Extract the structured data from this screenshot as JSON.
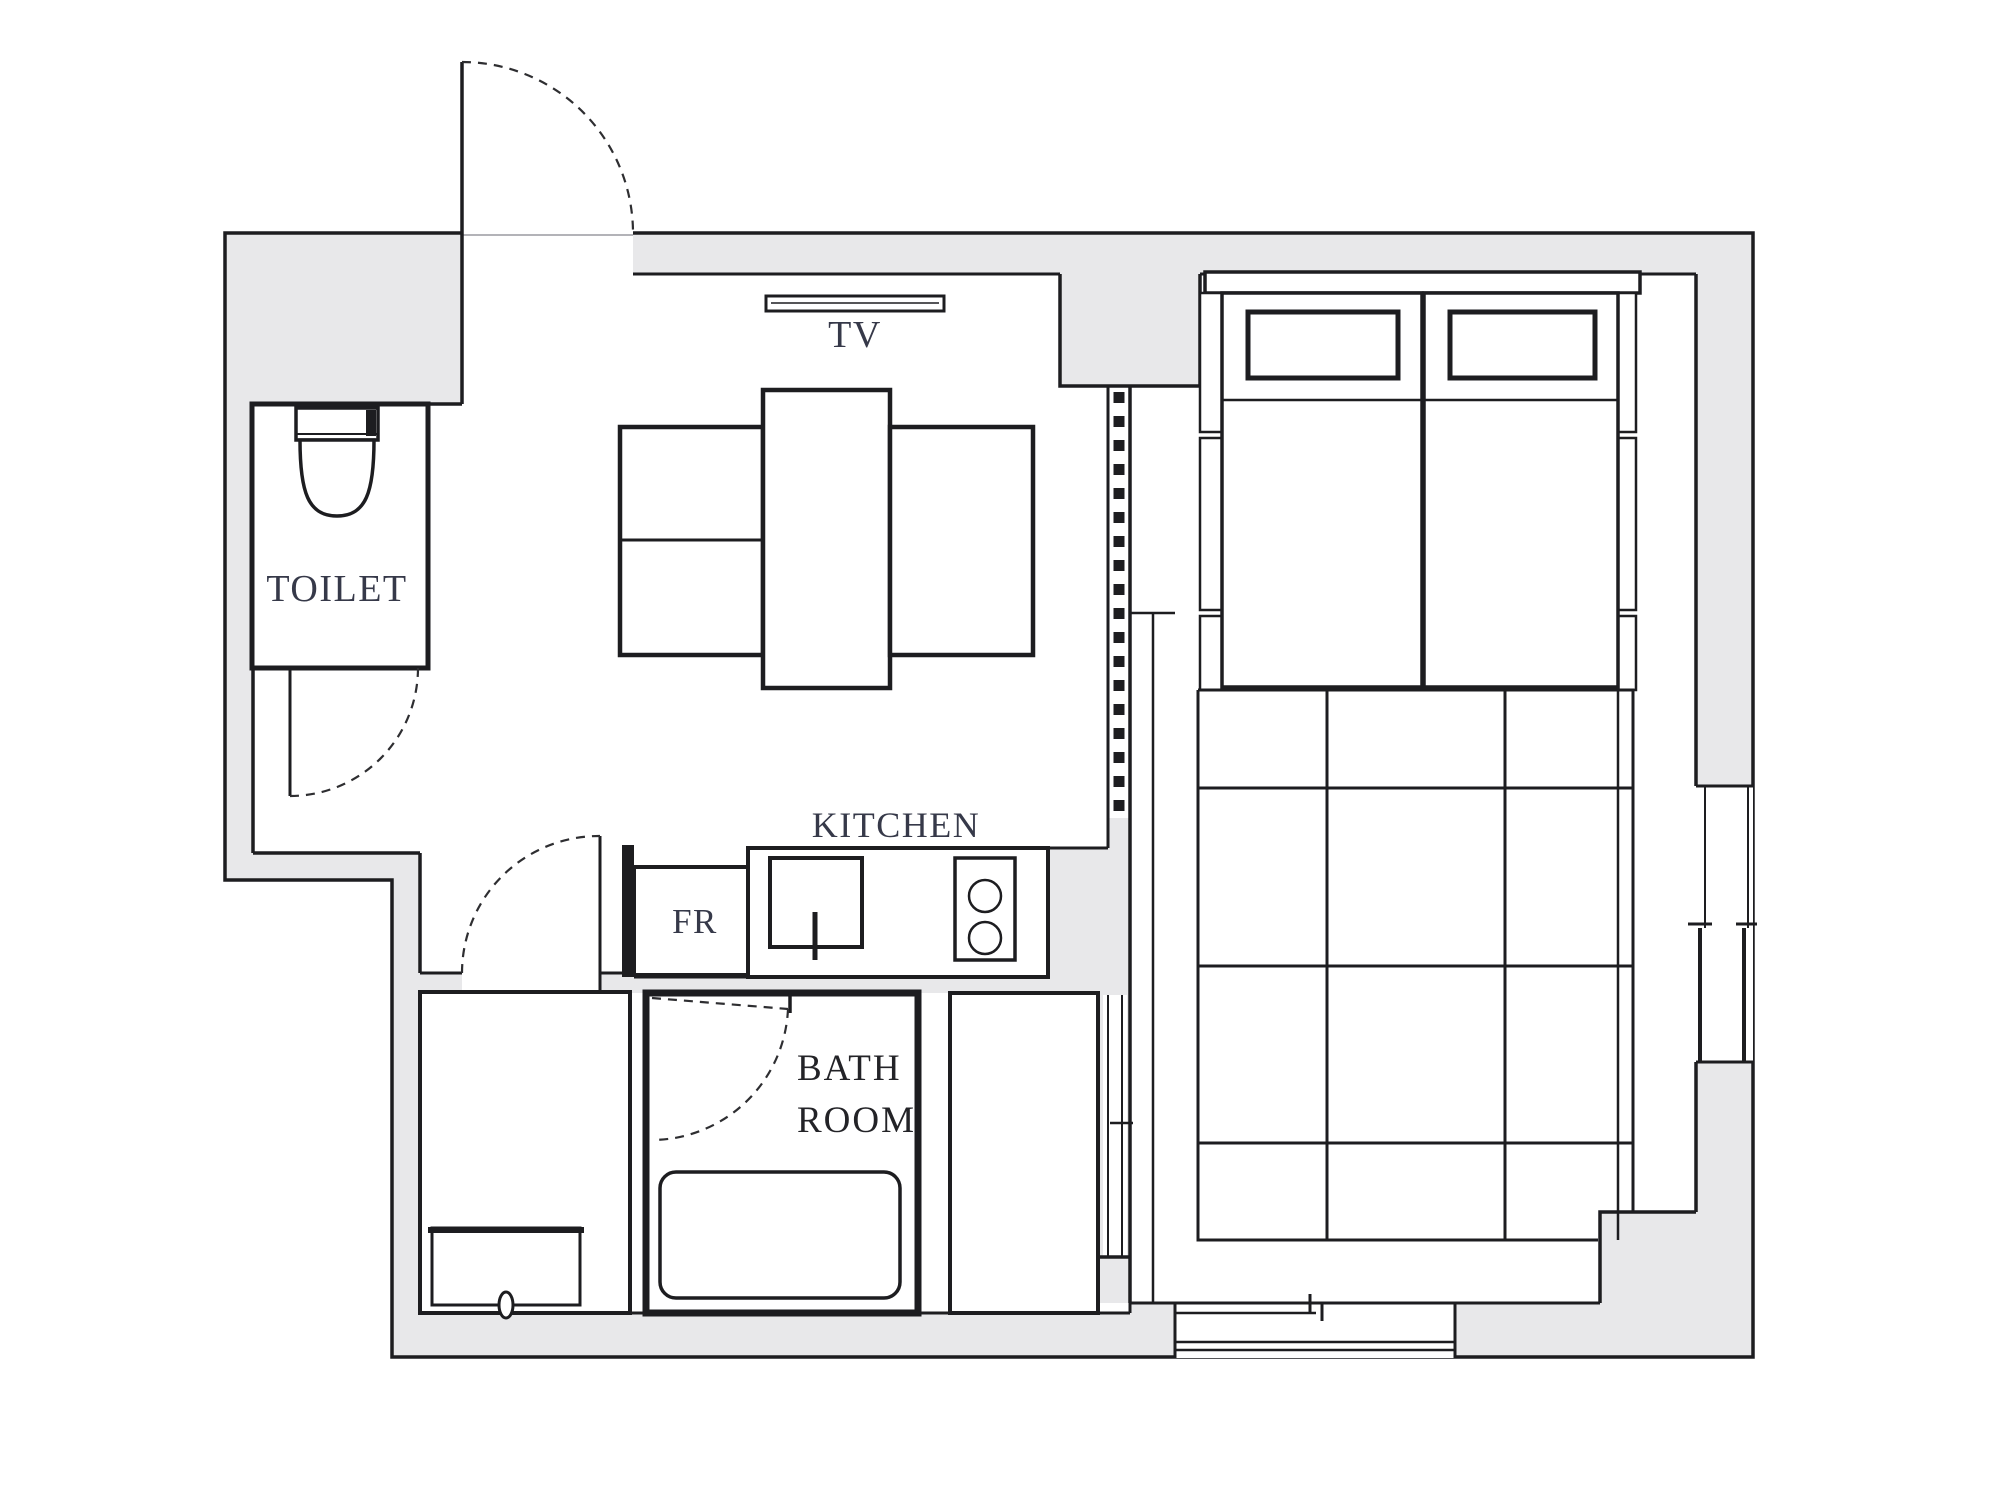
{
  "labels": {
    "tv": "TV",
    "toilet": "TOILET",
    "kitchen": "KITCHEN",
    "fridge": "FR",
    "bath_line1": "BATH",
    "bath_line2": "ROOM"
  },
  "colors": {
    "background": "#ffffff",
    "wall_fill": "#e8e8ea",
    "wall_line": "#1d1d20",
    "label_blue": "#363949",
    "label_black": "#232327"
  }
}
